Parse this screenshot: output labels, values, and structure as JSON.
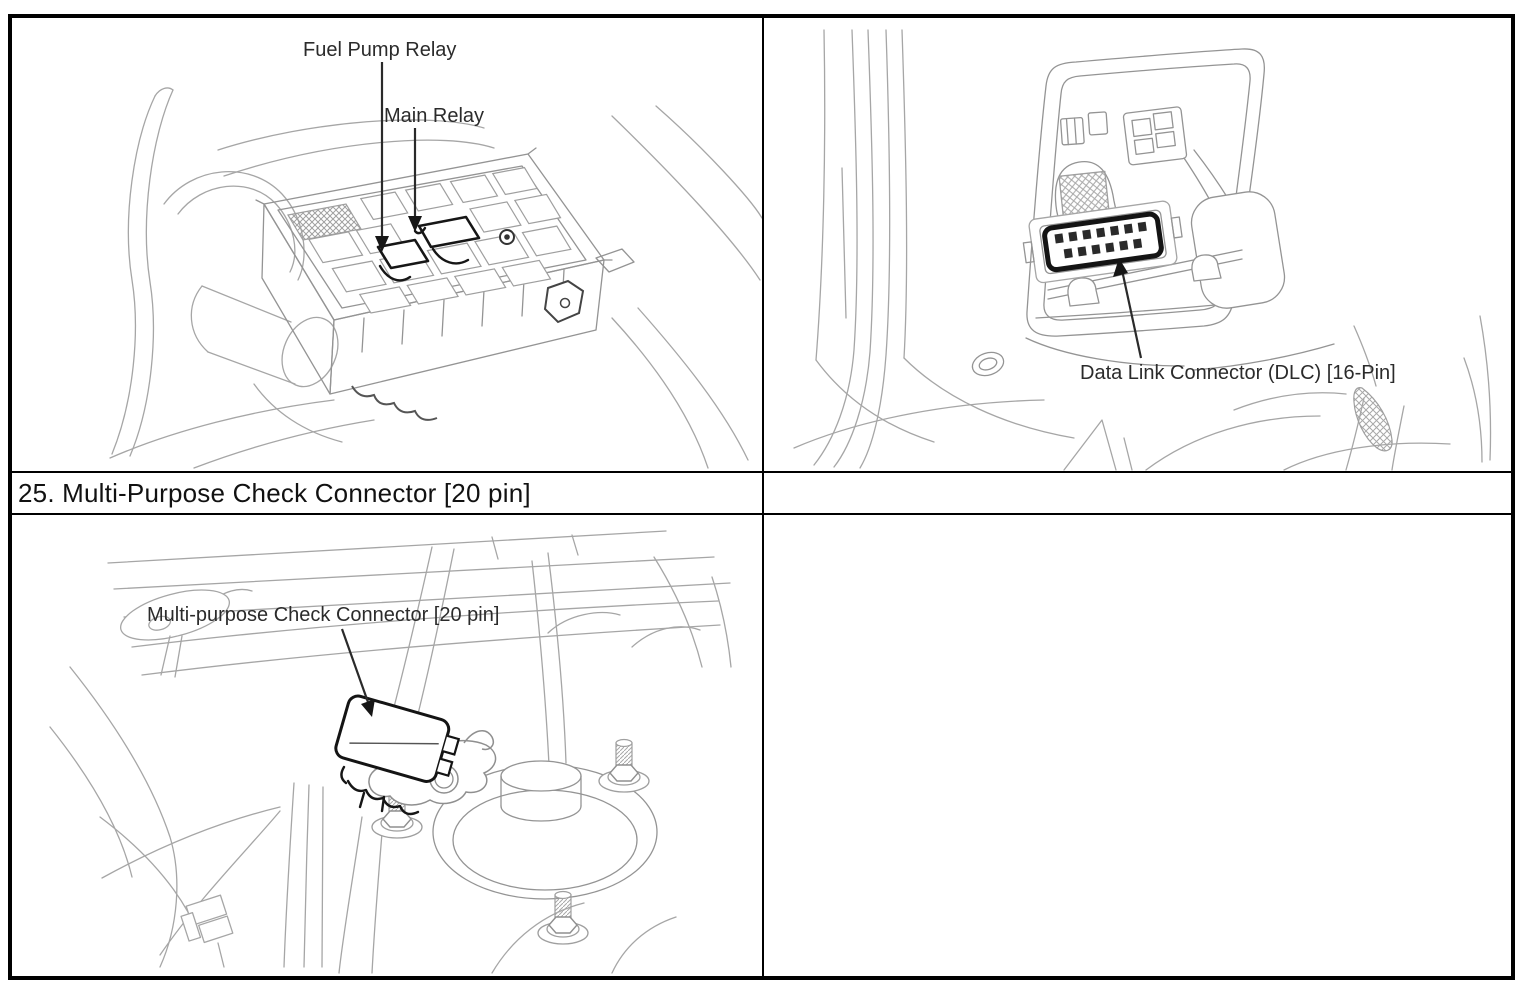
{
  "page": {
    "background": "#ffffff",
    "border_color": "#000000"
  },
  "title_row": {
    "text": "25. Multi-Purpose Check Connector [20 pin]"
  },
  "illustrations": {
    "top_left": {
      "label_fuel_pump": "Fuel Pump Relay",
      "label_main_relay": "Main Relay"
    },
    "top_right": {
      "label_dlc": "Data Link Connector (DLC) [16-Pin]"
    },
    "bottom_left": {
      "label_check_connector": "Multi-purpose Check Connector [20 pin]"
    }
  },
  "colors": {
    "line_gray": "#a6a6a6",
    "dark_line": "#161616",
    "label_text": "#2b2b2b"
  }
}
